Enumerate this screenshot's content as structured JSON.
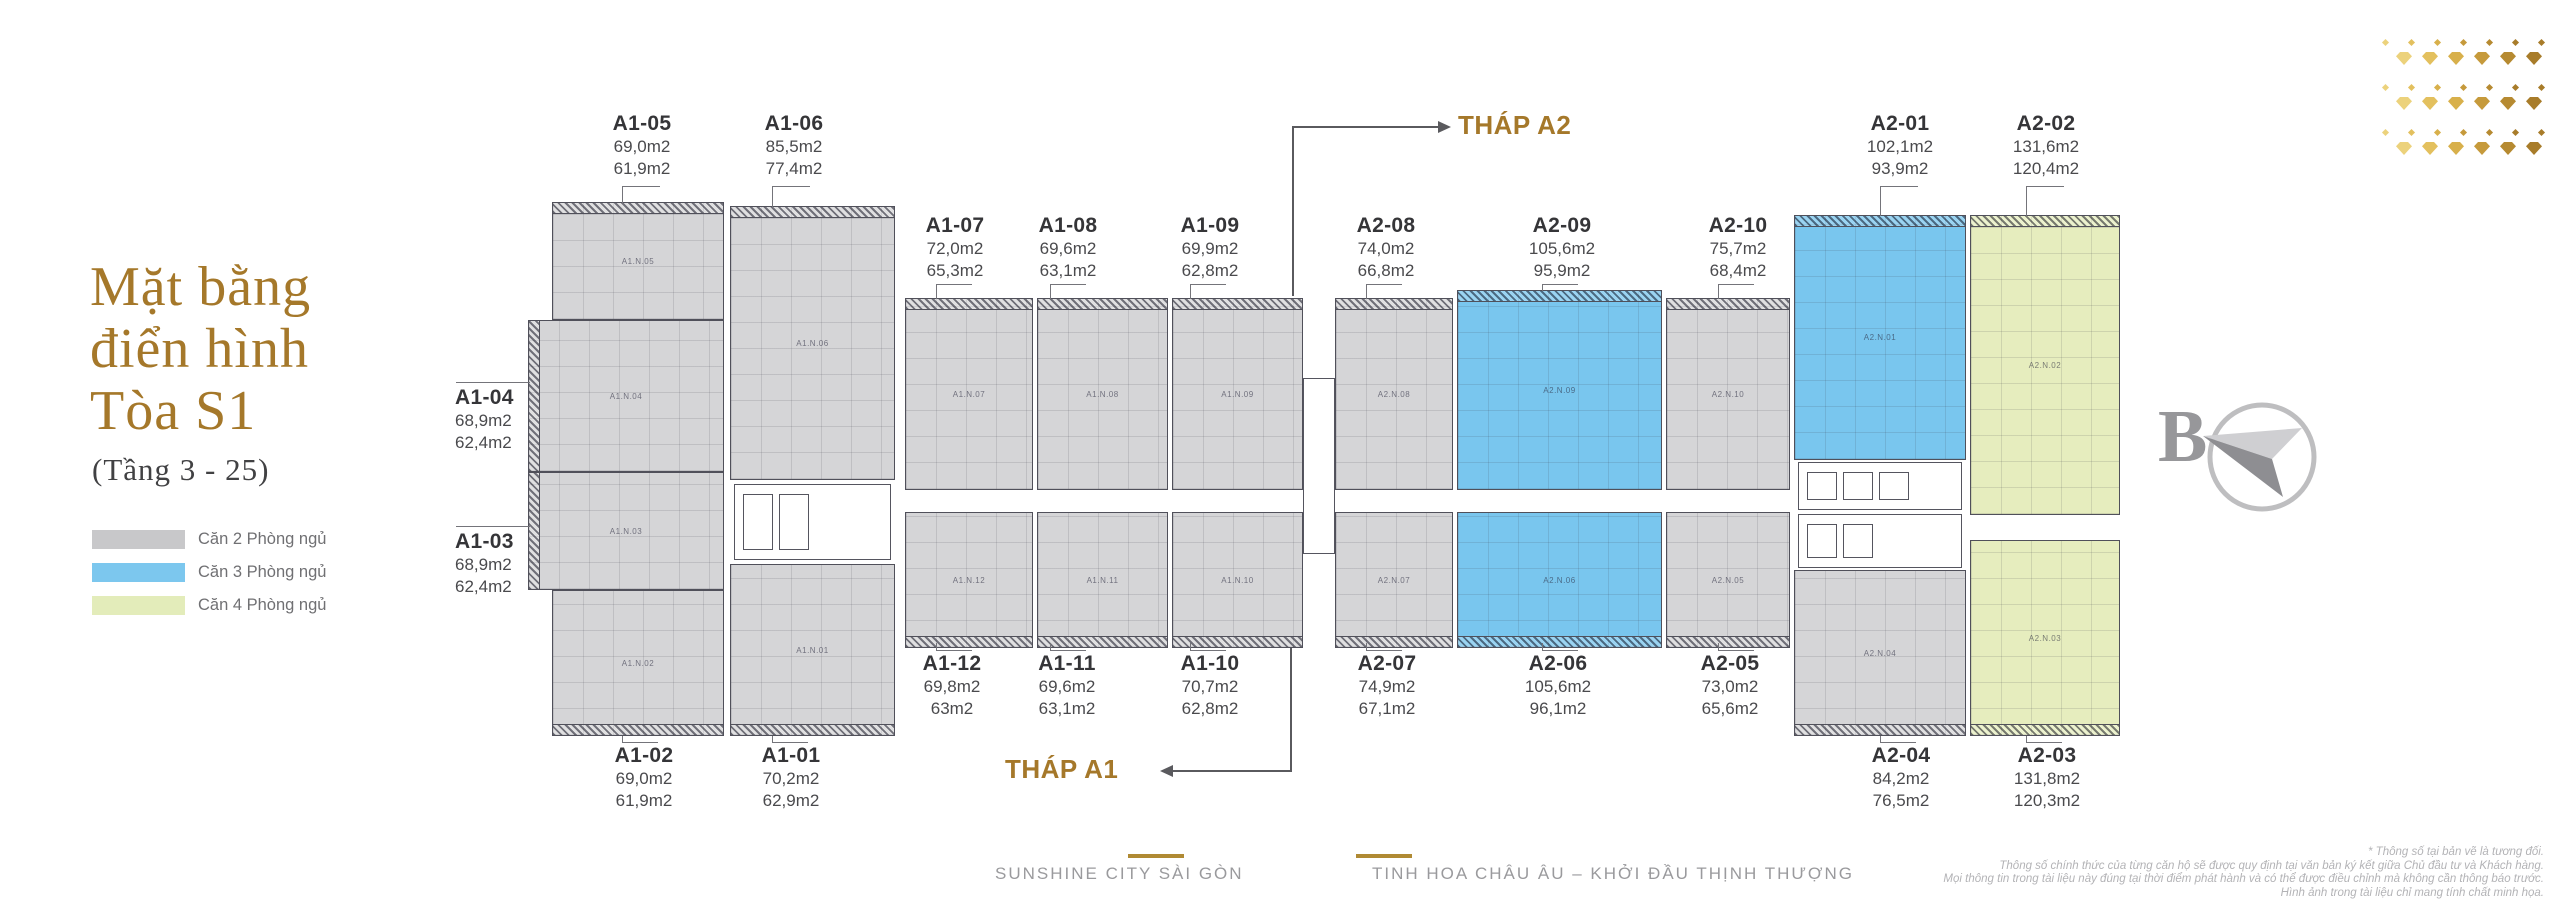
{
  "title": {
    "line1": "Mặt bằng",
    "line2": "điển hình",
    "line3": "Tòa S1",
    "subtitle": "(Tầng 3 - 25)"
  },
  "legend": {
    "items": [
      {
        "label": "Căn 2 Phòng ngủ",
        "color_key": "gray"
      },
      {
        "label": "Căn 3 Phòng ngủ",
        "color_key": "blue"
      },
      {
        "label": "Căn 4 Phòng ngủ",
        "color_key": "green"
      }
    ]
  },
  "colors": {
    "gray": "#d5d5d7",
    "blue": "#79c6ee",
    "green": "#e6edbe",
    "legend_gray": "#c8c8ca",
    "legend_blue": "#7cc7ee",
    "legend_green": "#e3ecba",
    "gold": "#a5782a"
  },
  "plan": {
    "tower_a2_label": "THÁP A2",
    "tower_a1_label": "THÁP A1",
    "units": [
      {
        "id": "A1-05",
        "code": "A1.N.05",
        "area1": "69,0m2",
        "area2": "61,9m2",
        "color": "gray",
        "block": {
          "x": 552,
          "y": 202,
          "w": 172,
          "h": 118
        },
        "hatch": "top",
        "label": {
          "x": 642,
          "y": 112,
          "align": "center"
        },
        "leaders": [
          [
            622,
            186,
            38,
            1
          ],
          [
            622,
            186,
            1,
            17
          ]
        ]
      },
      {
        "id": "A1-06",
        "code": "A1.N.06",
        "area1": "85,5m2",
        "area2": "77,4m2",
        "color": "gray",
        "block": {
          "x": 730,
          "y": 206,
          "w": 165,
          "h": 274
        },
        "hatch": "top",
        "label": {
          "x": 794,
          "y": 112,
          "align": "center"
        },
        "leaders": [
          [
            772,
            186,
            38,
            1
          ],
          [
            772,
            186,
            1,
            21
          ]
        ]
      },
      {
        "id": "A1-07",
        "code": "A1.N.07",
        "area1": "72,0m2",
        "area2": "65,3m2",
        "color": "gray",
        "block": {
          "x": 905,
          "y": 298,
          "w": 128,
          "h": 192
        },
        "hatch": "top",
        "label": {
          "x": 955,
          "y": 214,
          "align": "center"
        },
        "leaders": [
          [
            936,
            284,
            36,
            1
          ],
          [
            936,
            284,
            1,
            15
          ]
        ]
      },
      {
        "id": "A1-08",
        "code": "A1.N.08",
        "area1": "69,6m2",
        "area2": "63,1m2",
        "color": "gray",
        "block": {
          "x": 1037,
          "y": 298,
          "w": 131,
          "h": 192
        },
        "hatch": "top",
        "label": {
          "x": 1068,
          "y": 214,
          "align": "center"
        },
        "leaders": [
          [
            1050,
            284,
            36,
            1
          ],
          [
            1050,
            284,
            1,
            15
          ]
        ]
      },
      {
        "id": "A1-09",
        "code": "A1.N.09",
        "area1": "69,9m2",
        "area2": "62,8m2",
        "color": "gray",
        "block": {
          "x": 1172,
          "y": 298,
          "w": 131,
          "h": 192
        },
        "hatch": "top",
        "label": {
          "x": 1210,
          "y": 214,
          "align": "center"
        },
        "leaders": [
          [
            1190,
            284,
            36,
            1
          ],
          [
            1190,
            284,
            1,
            15
          ]
        ]
      },
      {
        "id": "A2-08",
        "code": "A2.N.08",
        "area1": "74,0m2",
        "area2": "66,8m2",
        "color": "gray",
        "block": {
          "x": 1335,
          "y": 298,
          "w": 118,
          "h": 192
        },
        "hatch": "top",
        "label": {
          "x": 1386,
          "y": 214,
          "align": "center"
        },
        "leaders": [
          [
            1366,
            284,
            36,
            1
          ],
          [
            1366,
            284,
            1,
            15
          ]
        ]
      },
      {
        "id": "A2-09",
        "code": "A2.N.09",
        "area1": "105,6m2",
        "area2": "95,9m2",
        "color": "blue",
        "block": {
          "x": 1457,
          "y": 290,
          "w": 205,
          "h": 200
        },
        "hatch": "top",
        "label": {
          "x": 1562,
          "y": 214,
          "align": "center"
        },
        "leaders": [
          [
            1542,
            284,
            36,
            1
          ],
          [
            1542,
            284,
            1,
            7
          ]
        ]
      },
      {
        "id": "A2-10",
        "code": "A2.N.10",
        "area1": "75,7m2",
        "area2": "68,4m2",
        "color": "gray",
        "block": {
          "x": 1666,
          "y": 298,
          "w": 124,
          "h": 192
        },
        "hatch": "top",
        "label": {
          "x": 1738,
          "y": 214,
          "align": "center"
        },
        "leaders": [
          [
            1718,
            284,
            36,
            1
          ],
          [
            1718,
            284,
            1,
            15
          ]
        ]
      },
      {
        "id": "A2-01",
        "code": "A2.N.01",
        "area1": "102,1m2",
        "area2": "93,9m2",
        "color": "blue",
        "block": {
          "x": 1794,
          "y": 215,
          "w": 172,
          "h": 245
        },
        "hatch": "top",
        "label": {
          "x": 1900,
          "y": 112,
          "align": "center"
        },
        "leaders": [
          [
            1880,
            186,
            38,
            1
          ],
          [
            1880,
            186,
            1,
            30
          ]
        ]
      },
      {
        "id": "A2-02",
        "code": "A2.N.02",
        "area1": "131,6m2",
        "area2": "120,4m2",
        "color": "green",
        "block": {
          "x": 1970,
          "y": 215,
          "w": 150,
          "h": 300
        },
        "hatch": "top",
        "label": {
          "x": 2046,
          "y": 112,
          "align": "center"
        },
        "leaders": [
          [
            2026,
            186,
            38,
            1
          ],
          [
            2026,
            186,
            1,
            30
          ]
        ]
      },
      {
        "id": "A1-04",
        "code": "A1.N.04",
        "area1": "68,9m2",
        "area2": "62,4m2",
        "color": "gray",
        "block": {
          "x": 528,
          "y": 320,
          "w": 196,
          "h": 152
        },
        "hatch": "left",
        "label": {
          "x": 455,
          "y": 386,
          "align": "left"
        },
        "leaders": [
          [
            456,
            382,
            74,
            1
          ]
        ]
      },
      {
        "id": "A1-03",
        "code": "A1.N.03",
        "area1": "68,9m2",
        "area2": "62,4m2",
        "color": "gray",
        "block": {
          "x": 528,
          "y": 472,
          "w": 196,
          "h": 118
        },
        "hatch": "left",
        "label": {
          "x": 455,
          "y": 530,
          "align": "left"
        },
        "leaders": [
          [
            456,
            526,
            74,
            1
          ]
        ]
      },
      {
        "id": "A1-02",
        "code": "A1.N.02",
        "area1": "69,0m2",
        "area2": "61,9m2",
        "color": "gray",
        "block": {
          "x": 552,
          "y": 590,
          "w": 172,
          "h": 146
        },
        "hatch": "bottom",
        "label": {
          "x": 644,
          "y": 744,
          "align": "center"
        },
        "leaders": [
          [
            622,
            742,
            36,
            1
          ],
          [
            622,
            736,
            1,
            7
          ]
        ]
      },
      {
        "id": "A1-01",
        "code": "A1.N.01",
        "area1": "70,2m2",
        "area2": "62,9m2",
        "color": "gray",
        "block": {
          "x": 730,
          "y": 564,
          "w": 165,
          "h": 172
        },
        "hatch": "bottom",
        "label": {
          "x": 791,
          "y": 744,
          "align": "center"
        },
        "leaders": [
          [
            772,
            742,
            36,
            1
          ],
          [
            772,
            736,
            1,
            7
          ]
        ]
      },
      {
        "id": "A1-12",
        "code": "A1.N.12",
        "area1": "69,8m2",
        "area2": "63m2",
        "color": "gray",
        "block": {
          "x": 905,
          "y": 512,
          "w": 128,
          "h": 136
        },
        "hatch": "bottom",
        "label": {
          "x": 952,
          "y": 652,
          "align": "center"
        },
        "leaders": [
          [
            936,
            650,
            36,
            1
          ],
          [
            936,
            643,
            1,
            8
          ]
        ]
      },
      {
        "id": "A1-11",
        "code": "A1.N.11",
        "area1": "69,6m2",
        "area2": "63,1m2",
        "color": "gray",
        "block": {
          "x": 1037,
          "y": 512,
          "w": 131,
          "h": 136
        },
        "hatch": "bottom",
        "label": {
          "x": 1067,
          "y": 652,
          "align": "center"
        },
        "leaders": [
          [
            1050,
            650,
            36,
            1
          ],
          [
            1050,
            643,
            1,
            8
          ]
        ]
      },
      {
        "id": "A1-10",
        "code": "A1.N.10",
        "area1": "70,7m2",
        "area2": "62,8m2",
        "color": "gray",
        "block": {
          "x": 1172,
          "y": 512,
          "w": 131,
          "h": 136
        },
        "hatch": "bottom",
        "label": {
          "x": 1210,
          "y": 652,
          "align": "center"
        },
        "leaders": [
          [
            1190,
            650,
            36,
            1
          ],
          [
            1190,
            643,
            1,
            8
          ]
        ]
      },
      {
        "id": "A2-07",
        "code": "A2.N.07",
        "area1": "74,9m2",
        "area2": "67,1m2",
        "color": "gray",
        "block": {
          "x": 1335,
          "y": 512,
          "w": 118,
          "h": 136
        },
        "hatch": "bottom",
        "label": {
          "x": 1387,
          "y": 652,
          "align": "center"
        },
        "leaders": [
          [
            1366,
            650,
            36,
            1
          ],
          [
            1366,
            643,
            1,
            8
          ]
        ]
      },
      {
        "id": "A2-06",
        "code": "A2.N.06",
        "area1": "105,6m2",
        "area2": "96,1m2",
        "color": "blue",
        "block": {
          "x": 1457,
          "y": 512,
          "w": 205,
          "h": 136
        },
        "hatch": "bottom",
        "label": {
          "x": 1558,
          "y": 652,
          "align": "center"
        },
        "leaders": [
          [
            1542,
            650,
            36,
            1
          ],
          [
            1542,
            643,
            1,
            8
          ]
        ]
      },
      {
        "id": "A2-05",
        "code": "A2.N.05",
        "area1": "73,0m2",
        "area2": "65,6m2",
        "color": "gray",
        "block": {
          "x": 1666,
          "y": 512,
          "w": 124,
          "h": 136
        },
        "hatch": "bottom",
        "label": {
          "x": 1730,
          "y": 652,
          "align": "center"
        },
        "leaders": [
          [
            1718,
            650,
            36,
            1
          ],
          [
            1718,
            643,
            1,
            8
          ]
        ]
      },
      {
        "id": "A2-04",
        "code": "A2.N.04",
        "area1": "84,2m2",
        "area2": "76,5m2",
        "color": "gray",
        "block": {
          "x": 1794,
          "y": 570,
          "w": 172,
          "h": 166
        },
        "hatch": "bottom",
        "label": {
          "x": 1901,
          "y": 744,
          "align": "center"
        },
        "leaders": [
          [
            1880,
            742,
            36,
            1
          ],
          [
            1880,
            736,
            1,
            7
          ]
        ]
      },
      {
        "id": "A2-03",
        "code": "A2.N.03",
        "area1": "131,8m2",
        "area2": "120,3m2",
        "color": "green",
        "block": {
          "x": 1970,
          "y": 540,
          "w": 150,
          "h": 196
        },
        "hatch": "bottom",
        "label": {
          "x": 2047,
          "y": 744,
          "align": "center"
        },
        "leaders": [
          [
            2026,
            742,
            36,
            1
          ],
          [
            2026,
            736,
            1,
            7
          ]
        ]
      }
    ],
    "cores": [
      {
        "name": "a1-core",
        "x": 734,
        "y": 484,
        "w": 157,
        "h": 76,
        "shafts": 2,
        "stairs": false
      },
      {
        "name": "a2-core-top",
        "x": 1798,
        "y": 462,
        "w": 164,
        "h": 48,
        "shafts": 3,
        "stairs": false
      },
      {
        "name": "a2-core-bottom",
        "x": 1798,
        "y": 514,
        "w": 164,
        "h": 54,
        "shafts": 2,
        "stairs": true
      },
      {
        "name": "link-bridge",
        "x": 1303,
        "y": 378,
        "w": 32,
        "h": 176,
        "shafts": 0,
        "stairs": false
      }
    ]
  },
  "compass": {
    "letter": "B"
  },
  "footer": {
    "brand1": "SUNSHINE CITY SÀI GÒN",
    "brand2": "TINH HOA CHÂU ÂU – KHỞI ĐẦU THỊNH THƯỢNG"
  },
  "disclaimer": {
    "lines": [
      "* Thông số tại bản vẽ là tương đối.",
      "Thông số chính thức của từng căn hộ sẽ được quy định tại văn bản ký kết giữa Chủ đầu tư và Khách hàng.",
      "Mọi thông tin trong tài liệu này đúng tại thời điểm phát hành và có thể được điều chỉnh mà không cần thông báo trước.",
      "Hình ảnh trong tài liệu chỉ mang tính chất minh họa."
    ]
  },
  "decoration": {
    "origin_x": 2396,
    "origin_y": 40,
    "cols": 6,
    "col_step": 26,
    "groups": [
      {
        "dots_dy": 0,
        "gems_dy": 12
      },
      {
        "dots_dy": 45,
        "gems_dy": 57
      },
      {
        "dots_dy": 90,
        "gems_dy": 102
      }
    ],
    "palette": [
      "#ecd27c",
      "#e3c05e",
      "#d8b04b",
      "#c69a3b",
      "#b68a31",
      "#a87c2a"
    ]
  }
}
